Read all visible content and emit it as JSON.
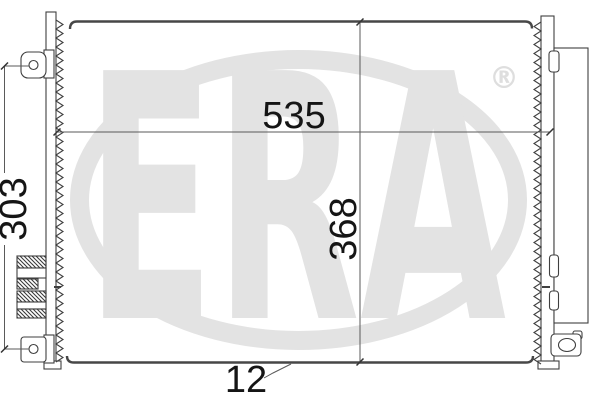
{
  "watermark": {
    "brand": "ERA",
    "registered_mark": "®",
    "color": "#e3e3e3"
  },
  "dimensions": {
    "overall_width": "535",
    "overall_height": "368",
    "mount_span": "303",
    "depth": "12"
  },
  "colors": {
    "background": "#ffffff",
    "part_outline": "#3f3f3f",
    "header_edge": "#474747",
    "dimension_line": "#5a5a5a",
    "label_text": "#151515",
    "watermark_gray": "#e3e3e3"
  }
}
